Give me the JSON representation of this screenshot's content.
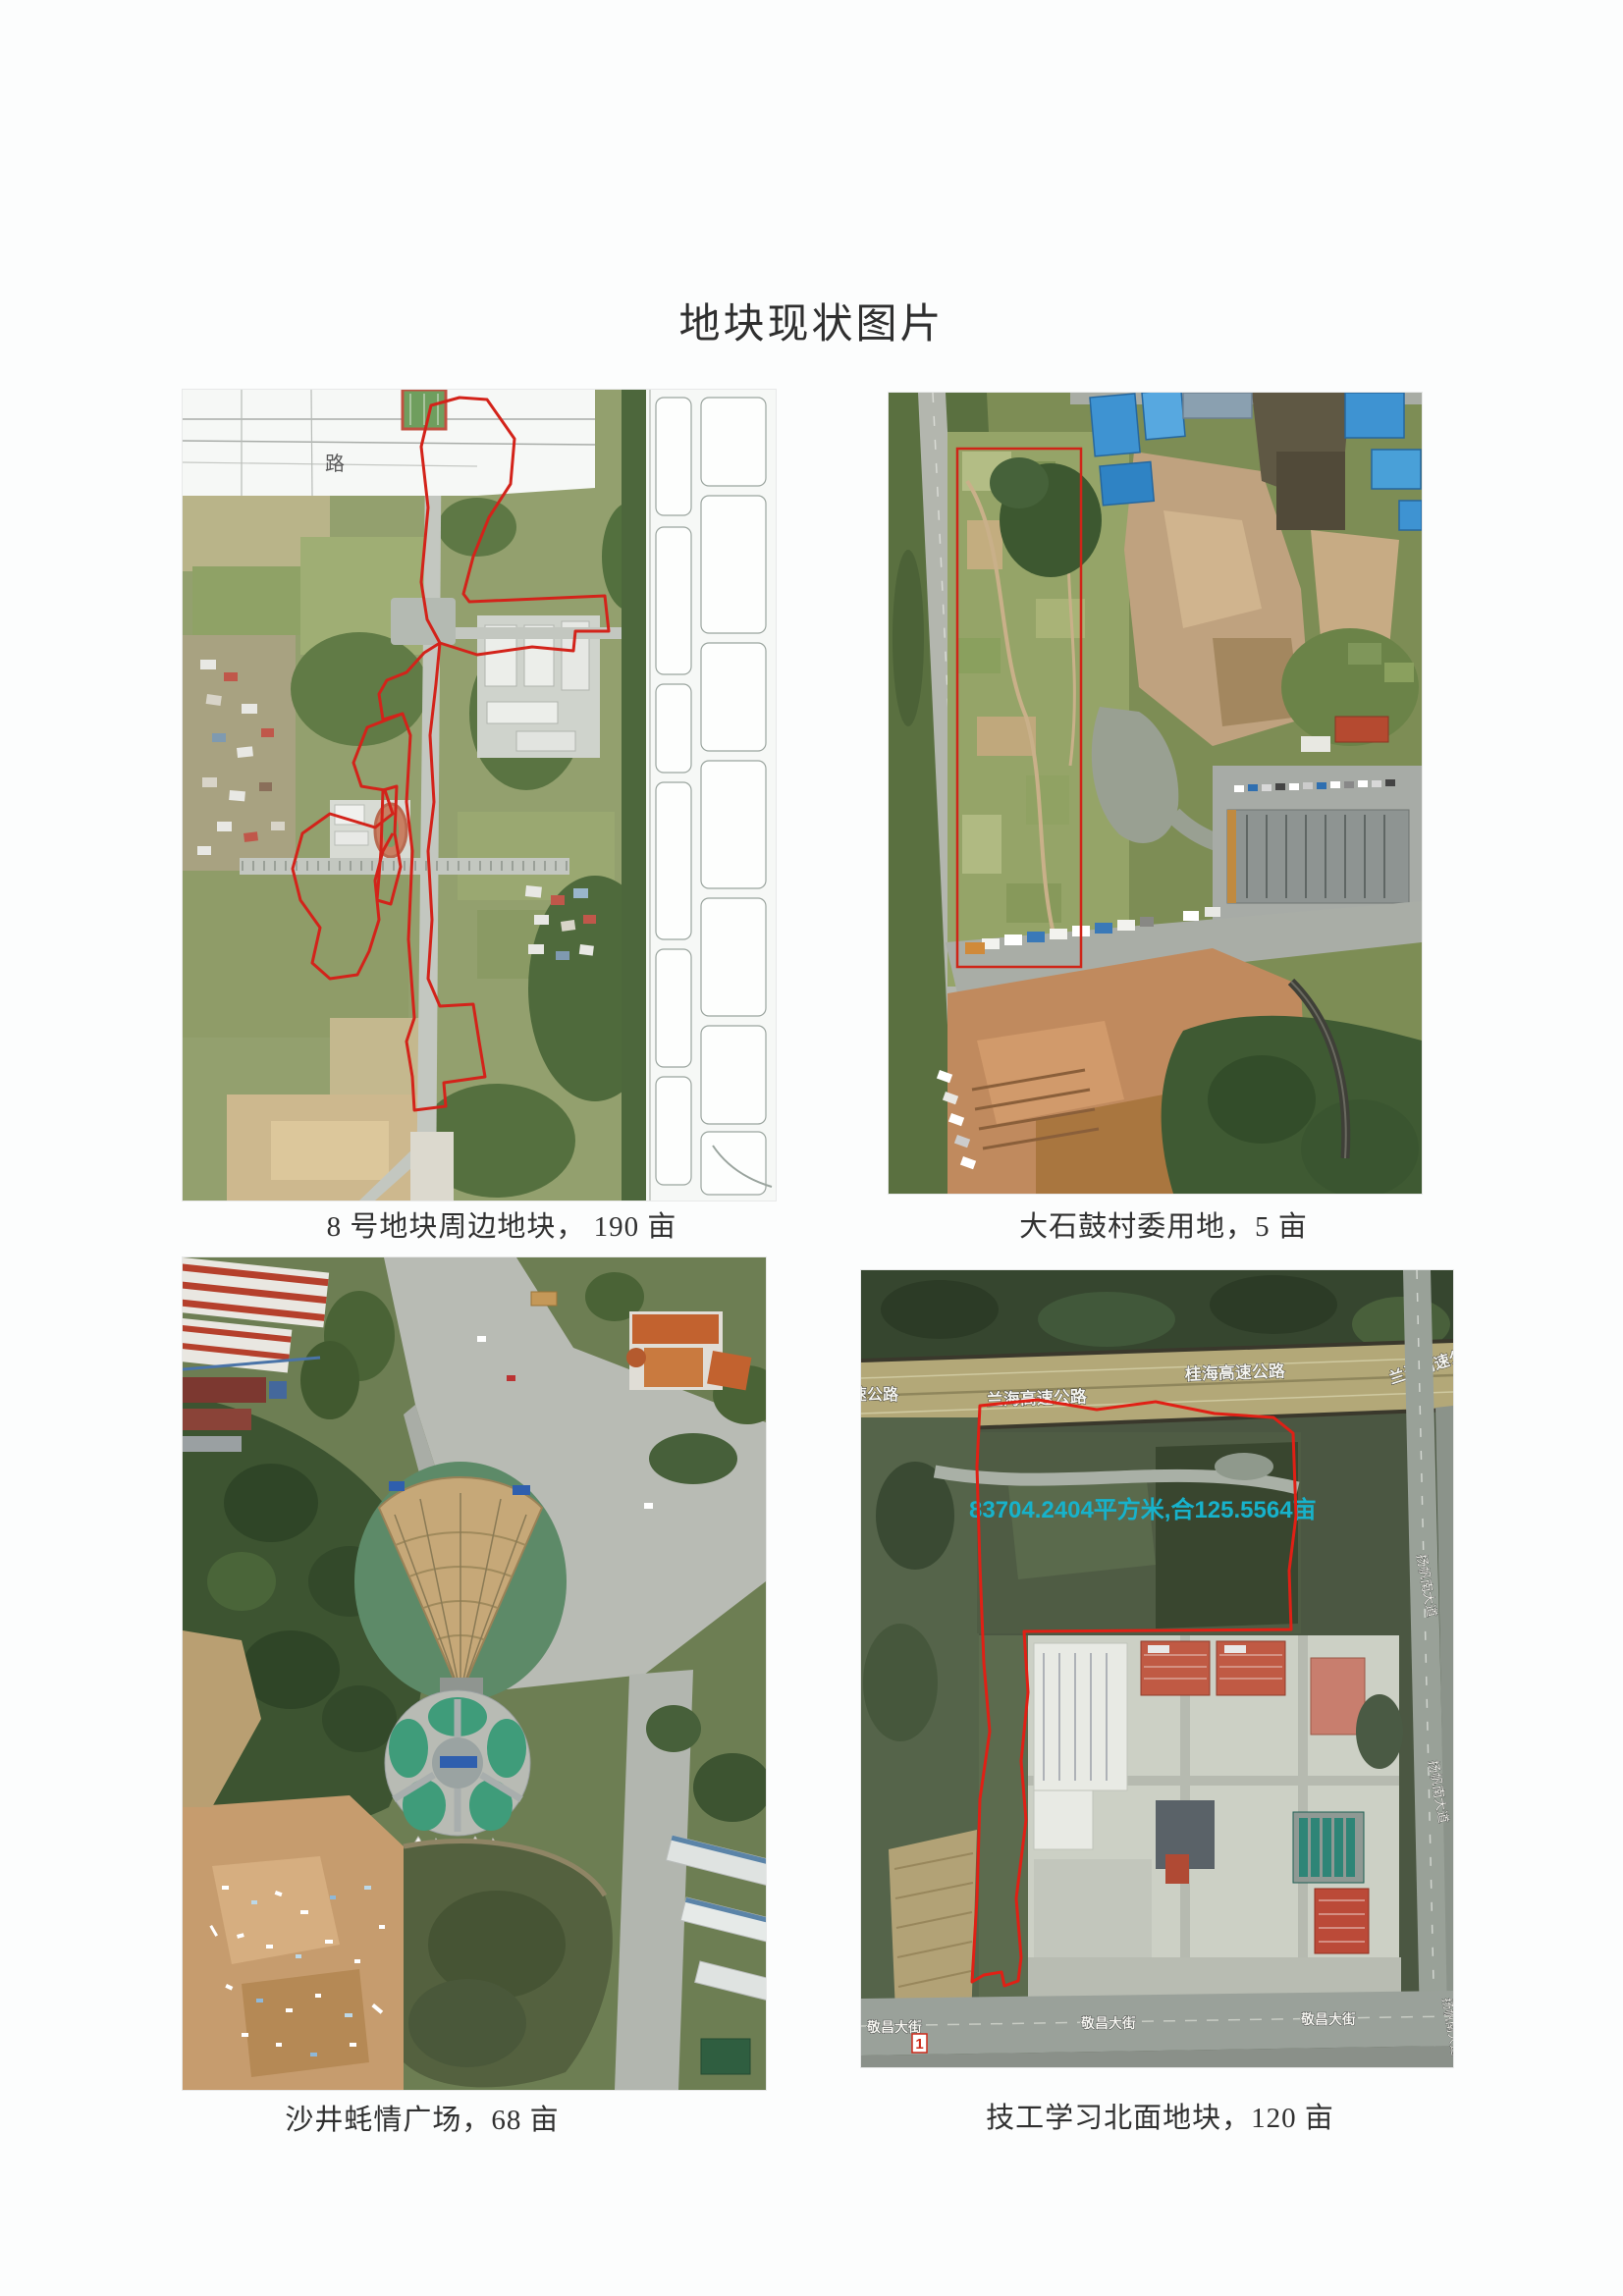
{
  "page": {
    "title": "地块现状图片"
  },
  "colors": {
    "plot_outline_red": "#d3231a",
    "area_label_cyan": "#17b2cb",
    "road_label_white": "#f5f5f0",
    "paper": "#fcfdfd"
  },
  "figures": {
    "plot8": {
      "caption": "8 号地块周边地块， 190 亩",
      "map_labels": {
        "road": "路"
      }
    },
    "dashigu": {
      "caption": "大石鼓村委用地，5 亩"
    },
    "shajing": {
      "caption": "沙井蚝情广场，68 亩"
    },
    "jigong": {
      "caption": "技工学习北面地块，120 亩",
      "map_labels": {
        "highway_gui": "桂海高速公路",
        "highway_lan": "兰海高速公路",
        "avenue_south": "扬帆南大道",
        "street": "敬昌大街",
        "area_text": "83704.2404平方米,合125.5564亩",
        "marker_1": "1"
      }
    }
  }
}
